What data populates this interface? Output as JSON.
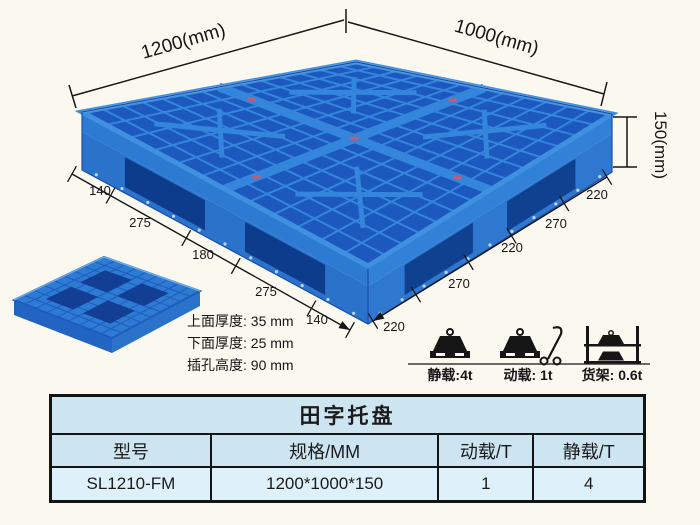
{
  "diagram": {
    "width_label": "1200(mm)",
    "depth_label": "1000(mm)",
    "height_label": "150(mm)",
    "left_chain": [
      "140",
      "275",
      "180",
      "275",
      "140"
    ],
    "right_chain": [
      "220",
      "270",
      "220",
      "270",
      "220"
    ],
    "spec_lines": [
      "上面厚度: 35 mm",
      "下面厚度: 25 mm",
      "插孔高度: 90 mm"
    ],
    "load_labels": [
      "静载:4t",
      "动载: 1t",
      "货架: 0.6t"
    ]
  },
  "table": {
    "title": "田字托盘",
    "headers": [
      "型号",
      "规格/MM",
      "动载/T",
      "静载/T"
    ],
    "row": [
      "SL1210-FM",
      "1200*1000*150",
      "1",
      "4"
    ]
  },
  "colors": {
    "pallet_blue": "#3386db",
    "pallet_dark_blue": "#1c58be",
    "pallet_hole": "#0e3c8c",
    "pallet_side": "#2d7ad2",
    "pallet_side_low": "#2a72ca",
    "line_color": "#161616",
    "table_header_bg": "#cde4f1",
    "table_row_bg": "#def0f9",
    "background": "#fbf8f0"
  }
}
